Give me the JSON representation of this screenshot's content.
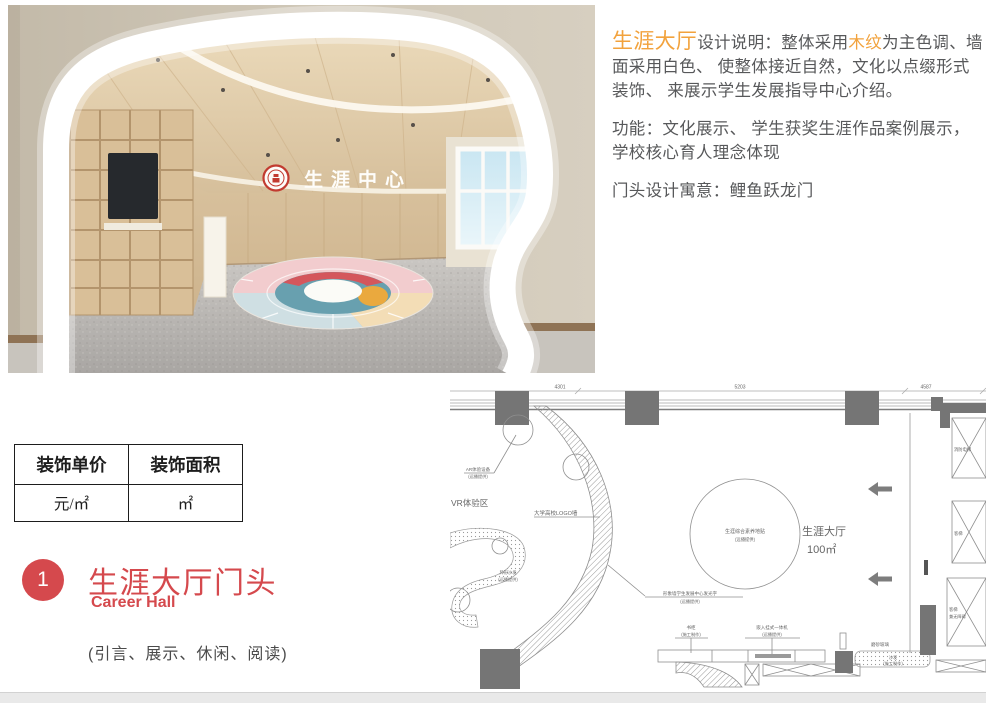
{
  "photo": {
    "wall_logo": "生涯中心"
  },
  "description": {
    "highlight_title": "生涯大厅",
    "seg1": "设计说明：整体采用",
    "highlight_wood": "木纹",
    "seg2": "为主色调、墙面采用白色、 使整体接近自然，文化以点缀形式装饰、 来展示学生发展指导中心介绍。",
    "function_text": "功能：文化展示、 学生获奖生涯作品案例展示，学校核心育人理念体现",
    "motto_text": "门头设计寓意：鲤鱼跃龙门"
  },
  "price_table": {
    "headers": [
      "装饰单价",
      "装饰面积"
    ],
    "values": [
      "元/㎡",
      "㎡"
    ]
  },
  "section": {
    "number": "1",
    "title": "生涯大厅门头",
    "subtitle": "Career Hall",
    "tags": "(引言、展示、休闲、阅读)"
  },
  "floorplan": {
    "dims": [
      "4301",
      "5203",
      "4587"
    ],
    "hall_label": "生涯大厅",
    "hall_area": "100㎡",
    "decal_label": "生涯综合素养地贴",
    "decal_sub": "(远播提供)",
    "ar_label": "AR体验设备",
    "ar_sub": "(远播提供)",
    "vr_label": "VR体验区",
    "logo_wall_label": "大学高校LOGO墙",
    "glow_label": "形象墙学生发展中心发光字",
    "glow_sub": "(远播提供)",
    "bookcase_label": "书柜",
    "bookcase_sub": "(施工制作)",
    "machine_label": "嵌入挂式一体机",
    "machine_sub": "(远播提供)",
    "frosted_label": "磨砂玻璃",
    "sofa_label": "沙发",
    "sofa_sub": "(施工制作)",
    "shaped_sofa_label": "异形沙发",
    "shaped_sofa_sub": "(远播提供)",
    "fire_elevator": "消防电梯",
    "elevator": "客梯",
    "elevator2": "客梯",
    "elevator2_sub": "兼无障碍"
  },
  "colors": {
    "accent_orange": "#F2A23C",
    "accent_red": "#D5494D",
    "body_text": "#57585A",
    "plan_line": "#8F8F8F"
  }
}
